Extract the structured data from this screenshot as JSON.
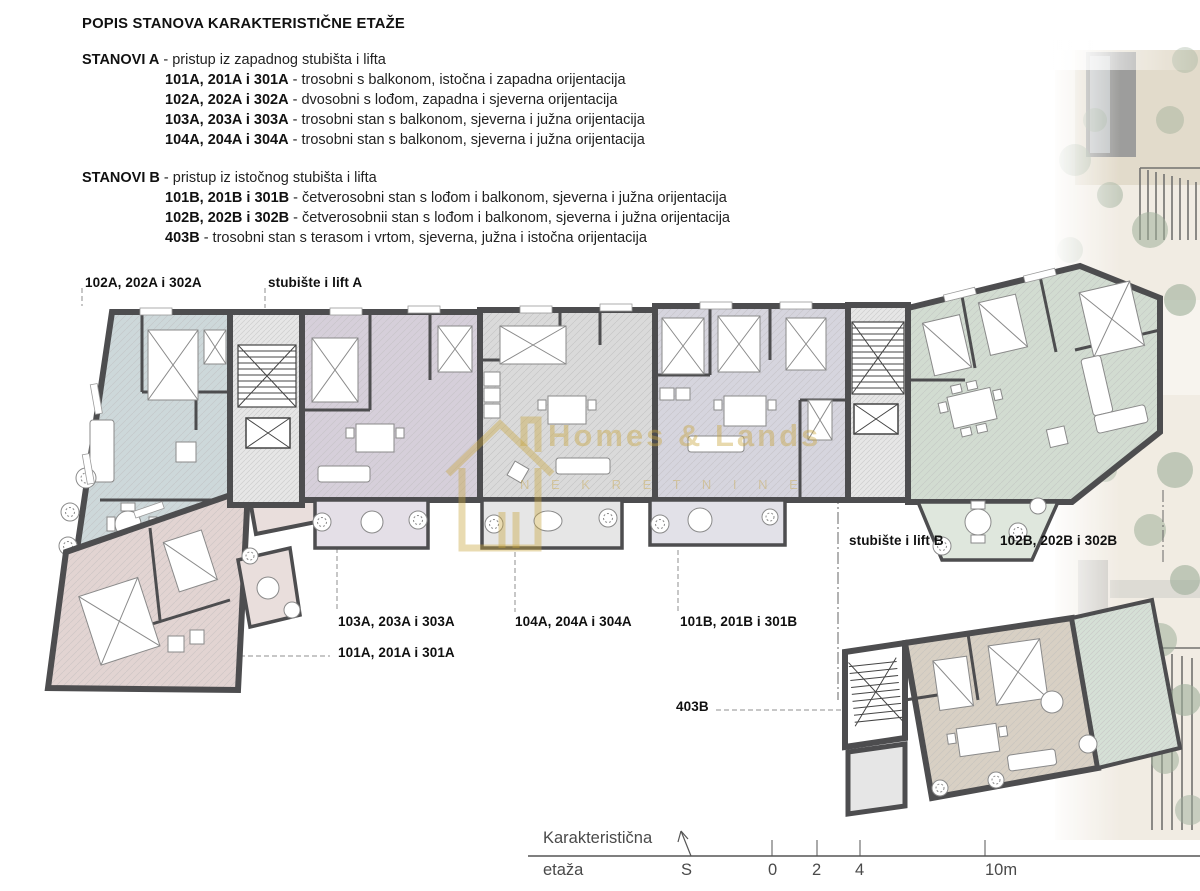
{
  "legend": {
    "title": "POPIS STANOVA KARAKTERISTIČNE ETAŽE",
    "groups": [
      {
        "name": "STANOVI A",
        "desc": " - pristup iz zapadnog stubišta i lifta",
        "items": [
          {
            "units": "101A, 201A i 301A",
            "desc": " - trosobni s balkonom, istočna i zapadna orijentacija"
          },
          {
            "units": "102A, 202A i 302A",
            "desc": " - dvosobni s lođom, zapadna i sjeverna orijentacija"
          },
          {
            "units": "103A, 203A i 303A",
            "desc": " - trosobni stan s balkonom, sjeverna i južna orijentacija"
          },
          {
            "units": "104A, 204A i 304A",
            "desc": " - trosobni stan s balkonom, sjeverna i južna orijentacija"
          }
        ]
      },
      {
        "name": "STANOVI B",
        "desc": " - pristup iz istočnog stubišta i lifta",
        "items": [
          {
            "units": "101B, 201B i 301B",
            "desc": " - četverosobni stan s lođom i balkonom, sjeverna i južna orijentacija"
          },
          {
            "units": "102B, 202B i 302B",
            "desc": " - četverosobnii stan s lođom i balkonom, sjeverna i južna orijentacija"
          },
          {
            "units": "403B",
            "desc": " - trosobni stan s terasom i vrtom, sjeverna, južna i istočna orijentacija"
          }
        ]
      }
    ]
  },
  "plan_labels": {
    "unit_102a": "102A, 202A i 302A",
    "stair_a": "stubište i lift A",
    "stair_b": "stubište i lift B",
    "unit_102b": "102B, 202B i 302B",
    "unit_103a": "103A, 203A i 303A",
    "unit_104a": "104A, 204A i 304A",
    "unit_101b": "101B, 201B i 301B",
    "unit_101a": "101A, 201A i 301A",
    "unit_403b": "403B"
  },
  "scale_bar": {
    "line1": "Karakteristična",
    "line2": "etaža",
    "north": "S",
    "t0": "0",
    "t2": "2",
    "t4": "4",
    "t10": "10m"
  },
  "watermark": {
    "title": "Homes & Lands",
    "subtitle": "N E K R E T N I N E"
  },
  "colors": {
    "wall": "#4d4d4f",
    "unit_102a": "#cdd8da",
    "unit_101a": "#e2d4d2",
    "unit_103a": "#d6cfda",
    "unit_104a": "#dadada",
    "unit_101b": "#d6d5de",
    "unit_102b": "#d2dcd1",
    "unit_403b": "#d8d0c4",
    "terrace_403b": "#d5e0d6",
    "stair_floor": "#e6e6e6",
    "watermark_gold": "#c9a43c"
  }
}
